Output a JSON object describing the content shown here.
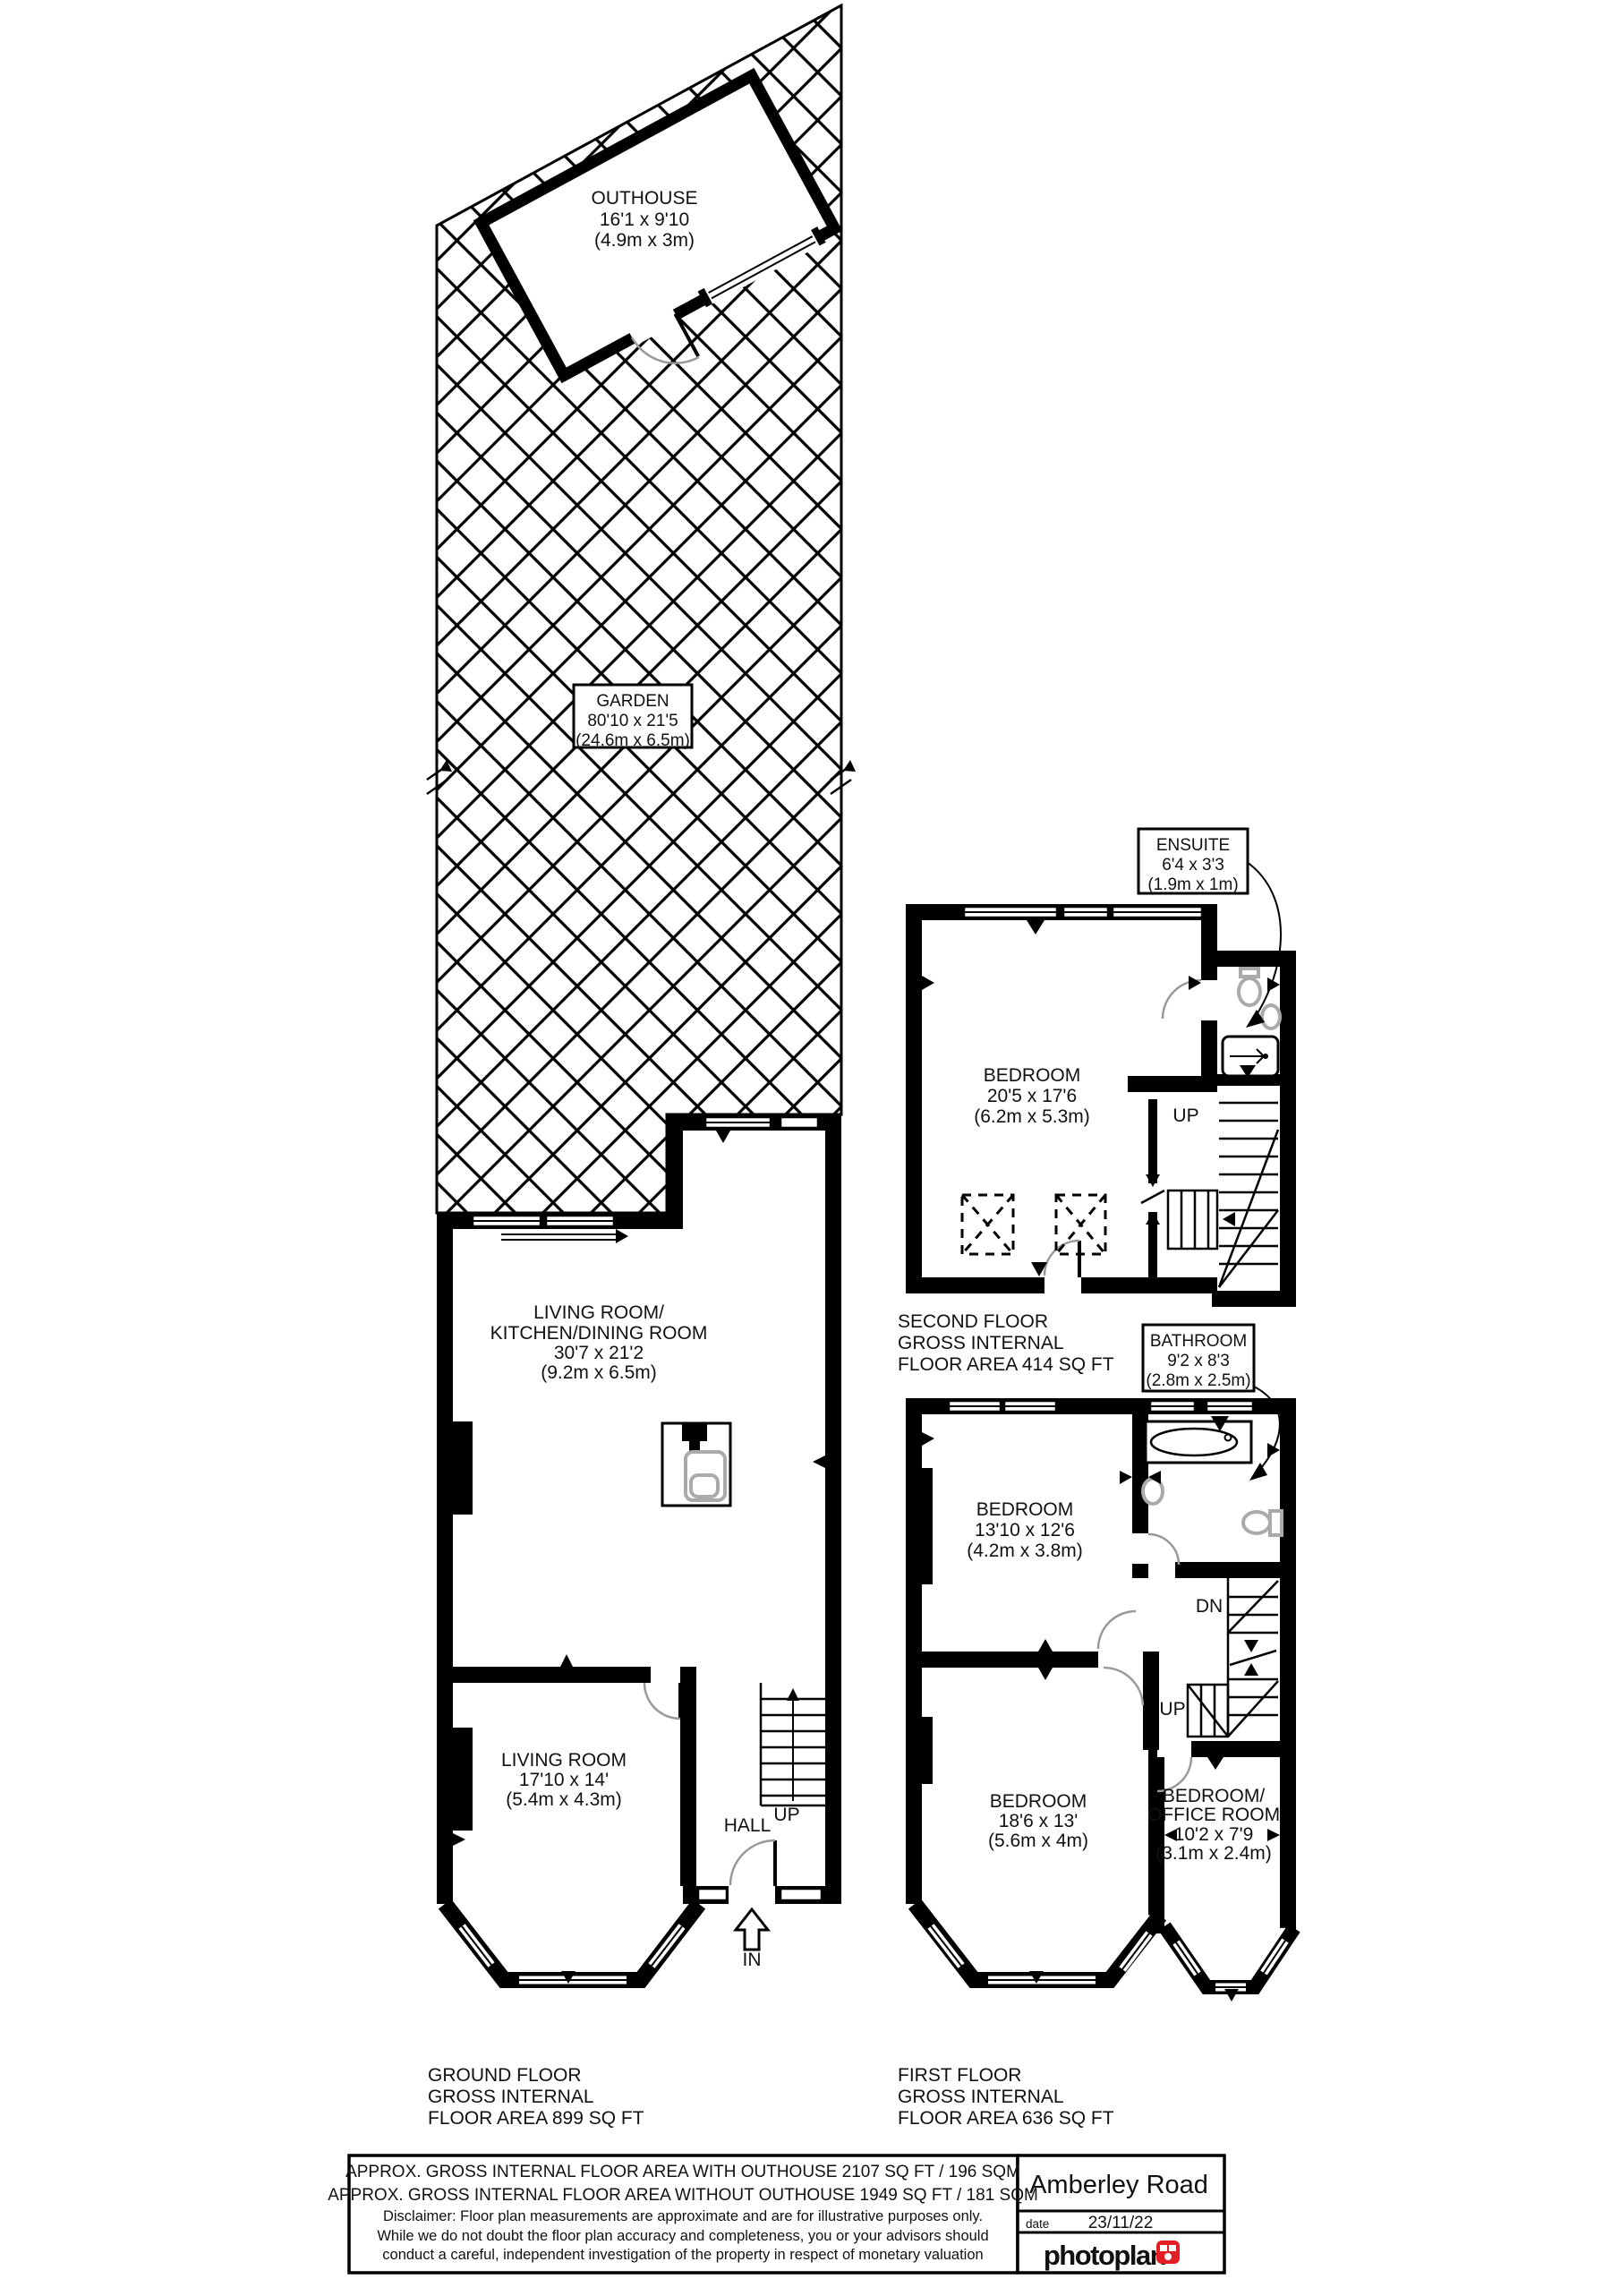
{
  "plan": {
    "rooms": {
      "outhouse": {
        "name": "OUTHOUSE",
        "size_ft": "16'1 x 9'10",
        "size_m": "(4.9m x 3m)"
      },
      "garden": {
        "name": "GARDEN",
        "size_ft": "80'10 x 21'5",
        "size_m": "(24.6m x 6.5m)"
      },
      "living_kitchen": {
        "name1": "LIVING ROOM/",
        "name2": "KITCHEN/DINING ROOM",
        "size_ft": "30'7 x 21'2",
        "size_m": "(9.2m x 6.5m)"
      },
      "living": {
        "name": "LIVING ROOM",
        "size_ft": "17'10 x 14'",
        "size_m": "(5.4m x 4.3m)"
      },
      "hall": {
        "name": "HALL"
      },
      "bedroom_second": {
        "name": "BEDROOM",
        "size_ft": "20'5 x 17'6",
        "size_m": "(6.2m x 5.3m)"
      },
      "ensuite": {
        "name": "ENSUITE",
        "size_ft": "6'4 x 3'3",
        "size_m": "(1.9m x 1m)"
      },
      "bathroom": {
        "name": "BATHROOM",
        "size_ft": "9'2 x 8'3",
        "size_m": "(2.8m x 2.5m)"
      },
      "bedroom_front": {
        "name": "BEDROOM",
        "size_ft": "13'10 x 12'6",
        "size_m": "(4.2m x 3.8m)"
      },
      "bedroom_back": {
        "name": "BEDROOM",
        "size_ft": "18'6 x 13'",
        "size_m": "(5.6m x 4m)"
      },
      "office": {
        "name1": "BEDROOM/",
        "name2": "OFFICE ROOM",
        "size_ft": "10'2 x 7'9",
        "size_m": "(3.1m x 2.4m)"
      }
    },
    "markers": {
      "up": "UP",
      "dn": "DN",
      "in": "IN"
    },
    "captions": {
      "ground": {
        "line1": "GROUND FLOOR",
        "line2": "GROSS INTERNAL",
        "line3": "FLOOR AREA 899 SQ FT"
      },
      "first": {
        "line1": "FIRST FLOOR",
        "line2": "GROSS INTERNAL",
        "line3": "FLOOR AREA 636 SQ FT"
      },
      "second": {
        "line1": "SECOND FLOOR",
        "line2": "GROSS INTERNAL",
        "line3": "FLOOR AREA 414 SQ FT"
      }
    }
  },
  "footer": {
    "area_with": "APPROX. GROSS INTERNAL FLOOR AREA WITH OUTHOUSE 2107 SQ FT / 196 SQM",
    "area_without": "APPROX. GROSS INTERNAL FLOOR AREA WITHOUT OUTHOUSE 1949 SQ FT / 181 SQM",
    "disclaimer1": "Disclaimer: Floor plan measurements are approximate and are for illustrative purposes only.",
    "disclaimer2": "While we do not doubt the floor plan accuracy and completeness, you or your advisors should",
    "disclaimer3": "conduct a careful, independent investigation of the property in respect of monetary valuation",
    "address": "Amberley Road",
    "date_label": "date",
    "date_value": "23/11/22",
    "logo_text": "photoplan",
    "logo_color": "#e31e24"
  }
}
